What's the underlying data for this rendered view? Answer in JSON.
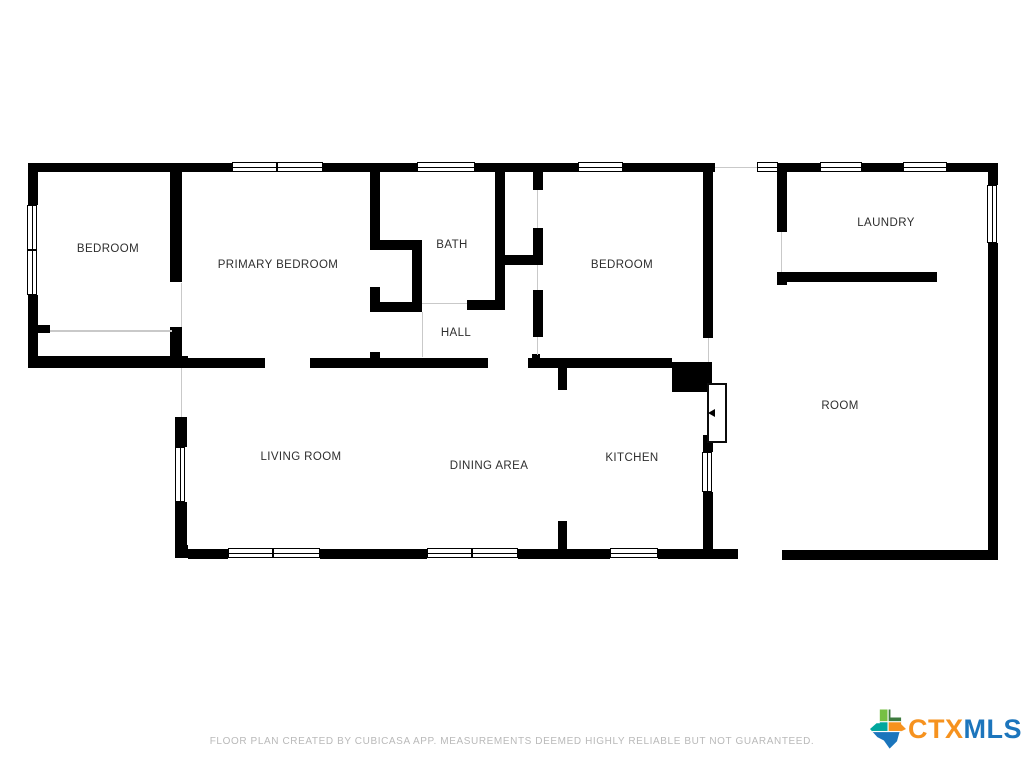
{
  "page": {
    "background": "#ffffff",
    "wall_color": "#000000",
    "opening_color": "#c9c9c9"
  },
  "rooms": [
    {
      "label": "BEDROOM",
      "x": 108,
      "y": 249
    },
    {
      "label": "PRIMARY BEDROOM",
      "x": 278,
      "y": 265
    },
    {
      "label": "BATH",
      "x": 452,
      "y": 245
    },
    {
      "label": "HALL",
      "x": 456,
      "y": 333
    },
    {
      "label": "BEDROOM",
      "x": 622,
      "y": 265
    },
    {
      "label": "LAUNDRY",
      "x": 886,
      "y": 223
    },
    {
      "label": "ROOM",
      "x": 840,
      "y": 406
    },
    {
      "label": "LIVING ROOM",
      "x": 301,
      "y": 457
    },
    {
      "label": "DINING AREA",
      "x": 489,
      "y": 466
    },
    {
      "label": "KITCHEN",
      "x": 632,
      "y": 458
    }
  ],
  "floorplan": {
    "walls": [
      [
        28,
        163,
        204,
        9
      ],
      [
        323,
        163,
        94,
        9
      ],
      [
        475,
        163,
        103,
        9
      ],
      [
        623,
        163,
        92,
        9
      ],
      [
        777,
        163,
        43,
        9
      ],
      [
        862,
        163,
        41,
        9
      ],
      [
        947,
        163,
        51,
        9
      ],
      [
        28,
        163,
        10,
        42
      ],
      [
        28,
        295,
        10,
        73
      ],
      [
        38,
        325,
        12,
        8
      ],
      [
        28,
        356,
        160,
        12
      ],
      [
        170,
        163,
        12,
        119
      ],
      [
        170,
        327,
        12,
        31
      ],
      [
        175,
        417,
        12,
        30
      ],
      [
        175,
        502,
        12,
        53
      ],
      [
        175,
        545,
        13,
        13
      ],
      [
        182,
        358,
        83,
        10
      ],
      [
        310,
        358,
        178,
        10
      ],
      [
        528,
        358,
        144,
        10
      ],
      [
        532,
        354,
        8,
        5
      ],
      [
        672,
        362,
        40,
        30
      ],
      [
        370,
        172,
        10,
        68
      ],
      [
        370,
        240,
        52,
        10
      ],
      [
        412,
        250,
        10,
        62
      ],
      [
        370,
        287,
        10,
        25
      ],
      [
        370,
        302,
        52,
        10
      ],
      [
        467,
        300,
        38,
        10
      ],
      [
        495,
        172,
        10,
        138
      ],
      [
        533,
        172,
        10,
        18
      ],
      [
        533,
        228,
        10,
        37
      ],
      [
        505,
        255,
        38,
        10
      ],
      [
        533,
        290,
        10,
        47
      ],
      [
        370,
        352,
        10,
        7
      ],
      [
        703,
        172,
        10,
        166
      ],
      [
        558,
        367,
        9,
        23
      ],
      [
        558,
        521,
        9,
        37
      ],
      [
        703,
        435,
        10,
        17
      ],
      [
        703,
        492,
        10,
        66
      ],
      [
        188,
        549,
        40,
        10
      ],
      [
        320,
        549,
        107,
        10
      ],
      [
        518,
        549,
        92,
        10
      ],
      [
        658,
        549,
        80,
        10
      ],
      [
        782,
        550,
        216,
        10
      ],
      [
        777,
        163,
        10,
        69
      ],
      [
        777,
        272,
        160,
        10
      ],
      [
        777,
        272,
        10,
        13
      ],
      [
        988,
        163,
        10,
        22
      ],
      [
        988,
        243,
        10,
        317
      ]
    ],
    "windows_h": [
      [
        232,
        162,
        45
      ],
      [
        277,
        162,
        46
      ],
      [
        417,
        162,
        58
      ],
      [
        578,
        162,
        45
      ],
      [
        757,
        162,
        21
      ],
      [
        820,
        162,
        42
      ],
      [
        903,
        162,
        44
      ],
      [
        228,
        548,
        45
      ],
      [
        273,
        548,
        47
      ],
      [
        427,
        548,
        45
      ],
      [
        472,
        548,
        46
      ],
      [
        610,
        548,
        48
      ]
    ],
    "windows_v": [
      [
        27,
        205,
        45
      ],
      [
        27,
        250,
        45
      ],
      [
        175,
        447,
        55
      ],
      [
        702,
        452,
        40
      ],
      [
        987,
        185,
        58
      ]
    ],
    "openings": [
      [
        181,
        283,
        1,
        44
      ],
      [
        50,
        330,
        122,
        2
      ],
      [
        181,
        368,
        1,
        49
      ],
      [
        422,
        303,
        45,
        1
      ],
      [
        422,
        312,
        1,
        45
      ],
      [
        537,
        190,
        1,
        38
      ],
      [
        537,
        265,
        1,
        25
      ],
      [
        537,
        337,
        1,
        18
      ],
      [
        708,
        338,
        1,
        24
      ],
      [
        781,
        232,
        1,
        40
      ],
      [
        715,
        167,
        42,
        1
      ]
    ],
    "door": {
      "x": 707,
      "y": 383,
      "w": 20,
      "h": 60,
      "arrow_x": 708,
      "arrow_y": 409
    }
  },
  "footer": {
    "text": "FLOOR PLAN CREATED BY CUBICASA APP. MEASUREMENTS DEEMED HIGHLY RELIABLE BUT NOT GUARANTEED."
  },
  "logo": {
    "prefix": "CTX",
    "suffix": "MLS",
    "prefix_color": "#f6921e",
    "suffix_color": "#1c75bc",
    "texas_colors": [
      "#76c043",
      "#3e7b3f",
      "#00a79d",
      "#f6921e",
      "#1b75bc"
    ]
  }
}
